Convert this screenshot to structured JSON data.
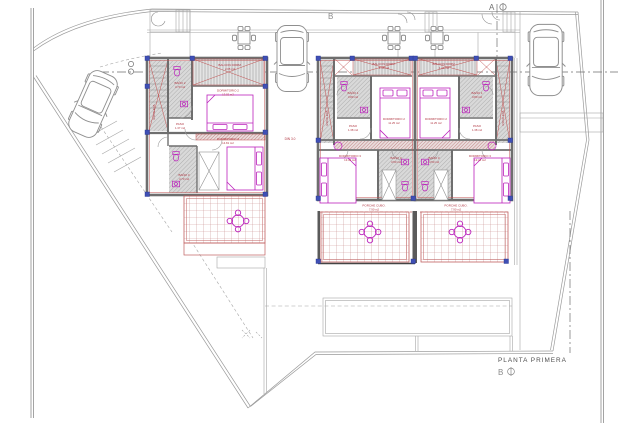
{
  "title_block": {
    "title": "PLANTA PRIMERA",
    "scale_mark": "B"
  },
  "section_markers": {
    "top": "A",
    "upper_left": "B"
  },
  "site_note": {
    "din": "DIN 3.0"
  },
  "colors": {
    "wall_gray": "#6e6e6e",
    "accent_red": "#c05050",
    "fixture_magenta": "#bb22bb",
    "hatch_gray": "#d6d6d6",
    "boundary_gray": "#9a9a9a",
    "corner_blue": "#3f4fb5",
    "label_red": "#b03540"
  },
  "units": [
    {
      "id": "villa-1",
      "rooms": {
        "escalera": {
          "name": "ESCALERA"
        },
        "balcon": {
          "name": "BALCON DORM.",
          "area": "2.05 m2"
        },
        "bano2": {
          "name": "BAÑO 2",
          "area": "4.70 m2"
        },
        "dorm2": {
          "name": "DORMITORIO 2",
          "area": "13.02 m2"
        },
        "paso": {
          "name": "PASO",
          "area": "1.37 m2"
        },
        "dorm3": {
          "name": "DORMITORIO 3",
          "area": "14.81 m2"
        },
        "bano3": {
          "name": "BAÑO 3",
          "area": "4.70 m2"
        }
      }
    },
    {
      "id": "villa-2",
      "rooms": {
        "escalera": {
          "name": "ESCALERA"
        },
        "balcon": {
          "name": "BALCON DORM.",
          "area": "1.46 m2"
        },
        "bano1": {
          "name": "BAÑO 1",
          "area": "3.80 m2"
        },
        "dorm2": {
          "name": "DORMITORIO 2",
          "area": "11.25 m2"
        },
        "paso": {
          "name": "PASO",
          "area": "1.38 m2"
        },
        "dorm3": {
          "name": "DORMITORIO 3",
          "area": "13.44 m2"
        },
        "bano3": {
          "name": "BAÑO 3",
          "area": "4.50 m2"
        },
        "porche": {
          "name": "PORCHE CUBO.",
          "area": "7.90 m2"
        }
      }
    },
    {
      "id": "villa-3",
      "rooms": {
        "escalera": {
          "name": "ESCALERA"
        },
        "balcon": {
          "name": "BALCON DORM.",
          "area": "1.46 m2"
        },
        "bano1": {
          "name": "BAÑO 1",
          "area": "3.80 m2"
        },
        "dorm2": {
          "name": "DORMITORIO 2",
          "area": "11.25 m2"
        },
        "paso": {
          "name": "PASO",
          "area": "1.38 m2"
        },
        "dorm3": {
          "name": "DORMITORIO 3",
          "area": "13.44 m2"
        },
        "bano3": {
          "name": "BAÑO 3",
          "area": "4.50 m2"
        },
        "porche": {
          "name": "PORCHE CUBO.",
          "area": "7.90 m2"
        }
      }
    }
  ]
}
